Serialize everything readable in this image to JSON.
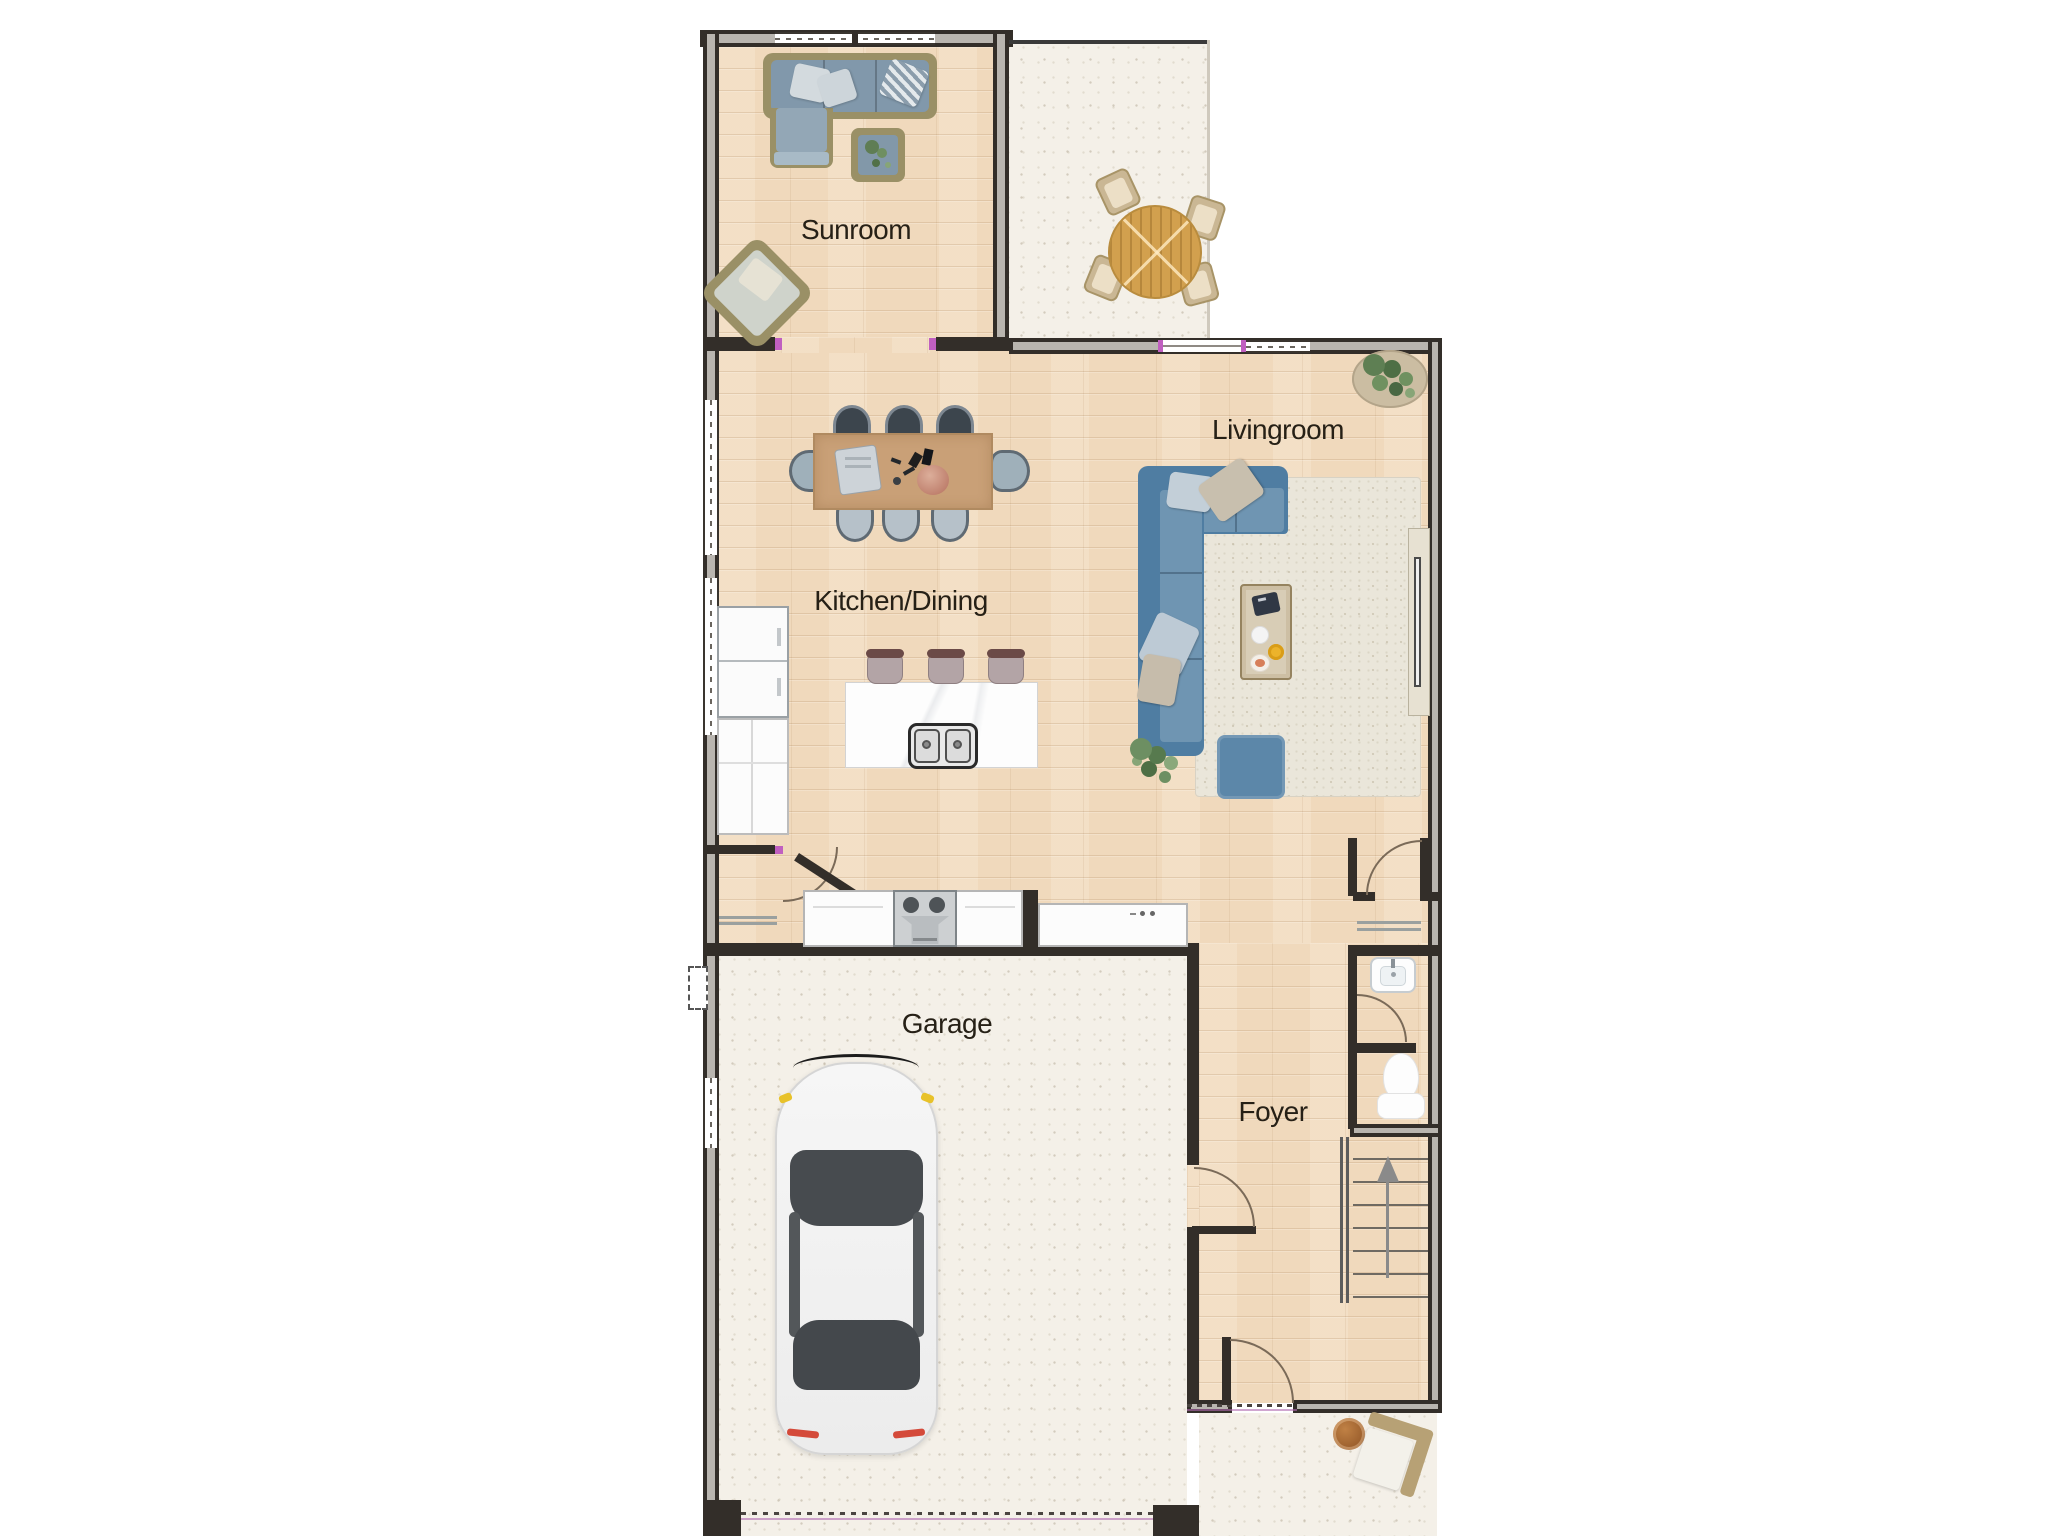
{
  "rooms": [
    {
      "id": "sunroom",
      "label": "Sunroom"
    },
    {
      "id": "kitchen_dining",
      "label": "Kitchen/Dining"
    },
    {
      "id": "livingroom",
      "label": "Livingroom"
    },
    {
      "id": "garage",
      "label": "Garage"
    },
    {
      "id": "foyer",
      "label": "Foyer"
    }
  ],
  "furniture_icons": [
    "sectional-sofa-icon",
    "lounge-armchair-icon",
    "plant-side-table-icon",
    "patio-round-table-icon",
    "patio-chair-icon",
    "dining-table-icon",
    "dining-chair-icon",
    "kitchen-island-icon",
    "bar-stool-icon",
    "double-sink-icon",
    "refrigerator-icon",
    "kitchen-counter-icon",
    "range-cooktop-icon",
    "l-shaped-sofa-icon",
    "coffee-table-icon",
    "ottoman-icon",
    "area-rug-icon",
    "potted-plant-icon",
    "tv-console-icon",
    "toilet-icon",
    "bathroom-sink-icon",
    "staircase-up-icon",
    "car-icon",
    "porch-chair-icon",
    "porch-table-icon",
    "door-swing-icon",
    "window-icon"
  ],
  "colors": {
    "wall": "#332e29",
    "wood_floor": "#f0d9bc",
    "concrete": "#f4f0e8",
    "sofa_blue": "#5d89ab",
    "sunroom_wicker": "#9a9066",
    "rug": "#eae6da",
    "dining_table_wood": "#c9a077",
    "patio_table_wood": "#d2a04e",
    "door_accent_pink": "#c05fc0",
    "car_body": "#f3f3f3",
    "label_text": "#262016"
  }
}
